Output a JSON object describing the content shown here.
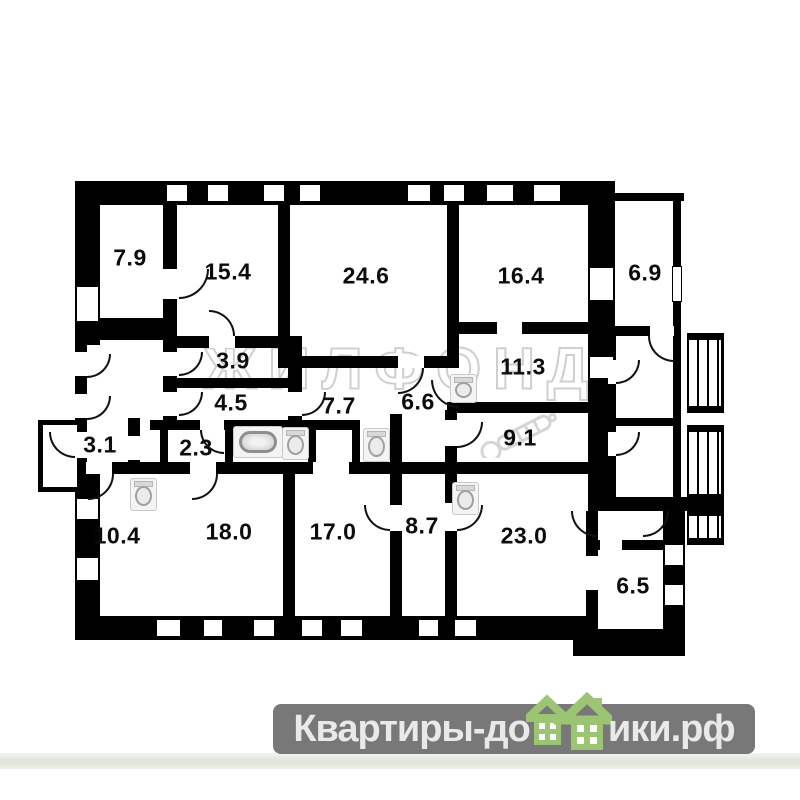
{
  "plan": {
    "wall_color": "#000000",
    "label_color": "#0c0c0c",
    "rooms": [
      {
        "id": "room-7-9",
        "area": "7.9"
      },
      {
        "id": "room-15-4",
        "area": "15.4"
      },
      {
        "id": "room-24-6",
        "area": "24.6"
      },
      {
        "id": "room-16-4",
        "area": "16.4"
      },
      {
        "id": "room-6-9",
        "area": "6.9"
      },
      {
        "id": "room-3-9",
        "area": "3.9"
      },
      {
        "id": "room-11-3",
        "area": "11.3"
      },
      {
        "id": "room-4-5",
        "area": "4.5"
      },
      {
        "id": "room-7-7",
        "area": "7.7"
      },
      {
        "id": "room-6-6",
        "area": "6.6"
      },
      {
        "id": "room-3-1",
        "area": "3.1"
      },
      {
        "id": "room-2-3",
        "area": "2.3"
      },
      {
        "id": "room-9-1",
        "area": "9.1"
      },
      {
        "id": "room-10-4",
        "area": "10.4"
      },
      {
        "id": "room-18-0",
        "area": "18.0"
      },
      {
        "id": "room-17-0",
        "area": "17.0"
      },
      {
        "id": "room-8-7",
        "area": "8.7"
      },
      {
        "id": "room-23-0",
        "area": "23.0"
      },
      {
        "id": "room-6-5",
        "area": "6.5"
      }
    ],
    "icons": {
      "bathtub": "bathtub-icon",
      "toilet": "toilet-icon",
      "stairs": "stairs-icon",
      "door": "door-arc",
      "window": "window-opening"
    }
  },
  "watermark": {
    "agency": "ЖИЛФОНД",
    "color": "#c7c7c7"
  },
  "footer_logo": {
    "prefix": "Квартиры-до",
    "suffix": "ики.рф",
    "bg_color": "#787878",
    "text_color": "#e9e9e9",
    "house_green": "#9bc473"
  }
}
